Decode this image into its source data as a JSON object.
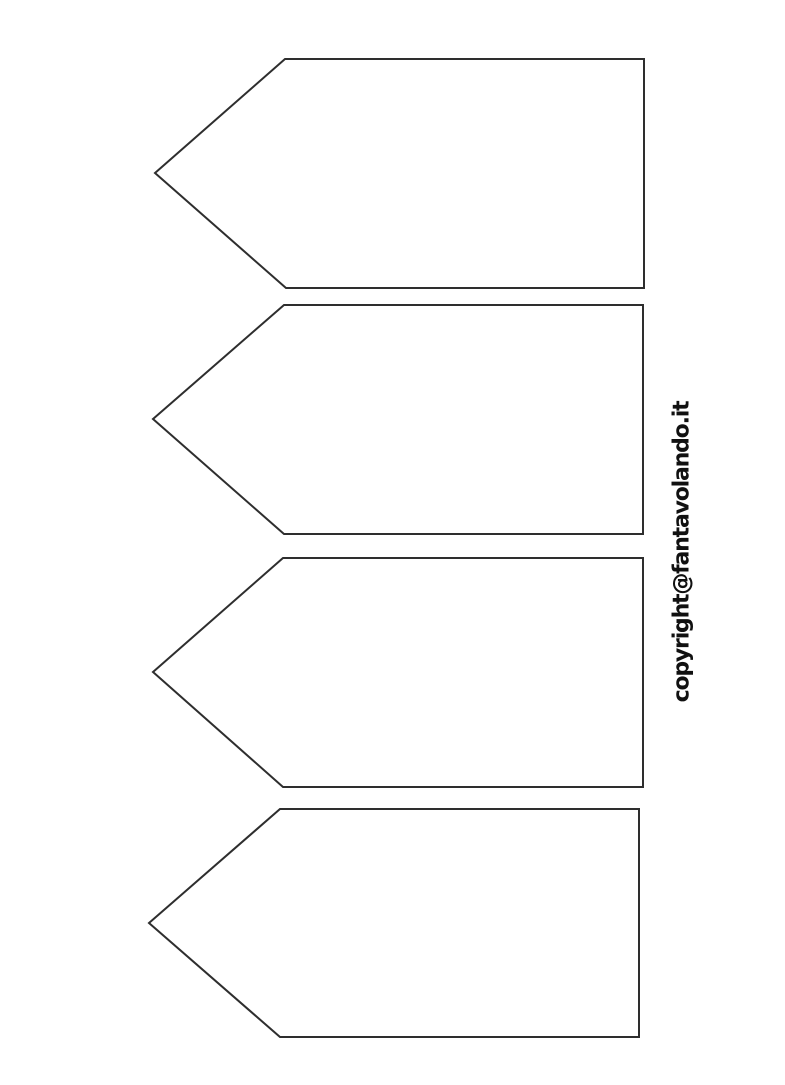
{
  "page": {
    "background_color": "#ffffff",
    "kind": "printable blank tag template"
  },
  "watermark": {
    "text": "copyright@fantavolando.it",
    "color": "#111111",
    "orientation": "vertical-bottom-to-top"
  },
  "tags": {
    "count": 4,
    "stroke_color": "#2e2e2e",
    "fill_color": "#ffffff",
    "items": [
      {
        "label": ""
      },
      {
        "label": ""
      },
      {
        "label": ""
      },
      {
        "label": ""
      }
    ]
  }
}
